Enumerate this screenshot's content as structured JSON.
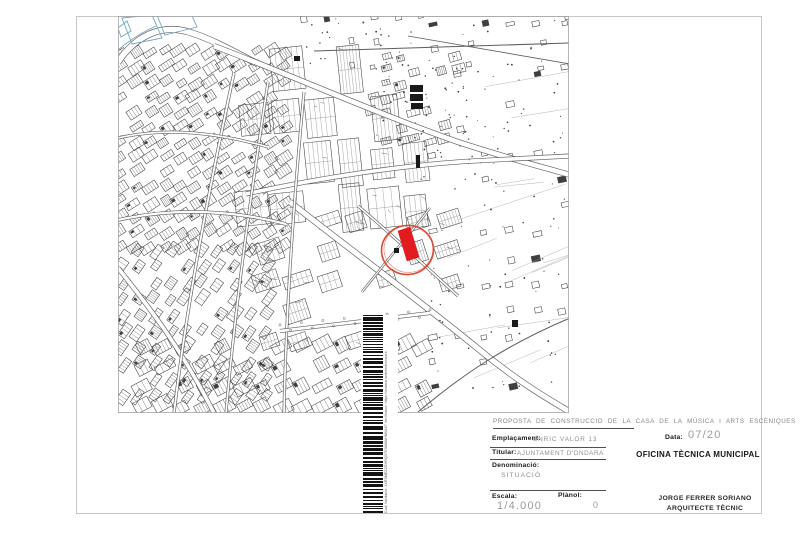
{
  "page": {
    "width": 800,
    "height": 533,
    "bg": "#ffffff"
  },
  "frame": {
    "x": 76,
    "y": 16,
    "w": 686,
    "h": 498,
    "color": "#c6c6c6"
  },
  "map": {
    "viewport": {
      "x": 118,
      "y": 16,
      "w": 451,
      "h": 397,
      "border": "#a5a5a5"
    },
    "ink": "#3f3f3f",
    "ink_faint": "#6f6f6f",
    "road_casing": "#5e5e5e",
    "blue": "#6fa8c4",
    "red_fill": "#e21b1e",
    "red_stroke": "#dc4a33",
    "seed": 42,
    "highlight": {
      "circle": {
        "cx": 289.5,
        "cy": 234,
        "rx": 26,
        "ry": 24.5,
        "rot": -8
      },
      "parcel": [
        [
          280,
          215
        ],
        [
          292,
          211
        ],
        [
          301,
          241
        ],
        [
          289,
          245
        ]
      ]
    },
    "blue_fields": [
      [
        [
          4,
          2
        ],
        [
          34,
          -1
        ],
        [
          44,
          22
        ],
        [
          14,
          28
        ]
      ],
      [
        [
          37,
          -6
        ],
        [
          70,
          -9
        ],
        [
          79,
          11
        ],
        [
          47,
          19
        ]
      ],
      [
        [
          0,
          12
        ],
        [
          9,
          5
        ],
        [
          13,
          15
        ],
        [
          3,
          21
        ]
      ]
    ],
    "blue_line": "M0,34 C12,24 24,16 38,10",
    "roads": [
      {
        "d": "M0,46 C16,22 42,6 74,17 C98,25 118,37 140,48",
        "w": 7,
        "core": true
      },
      {
        "d": "M96,30 C170,58 260,98 340,126 C392,143 428,152 452,159",
        "w": 6,
        "core": true
      },
      {
        "d": "M196,35 L452,27",
        "w": 1,
        "core": false
      },
      {
        "d": "M128,178 C200,162 285,149 355,145 C392,143 428,141 452,140",
        "w": 5,
        "core": true
      },
      {
        "d": "M172,186 C225,228 298,282 358,331 C400,366 432,384 452,396",
        "w": 6.5,
        "core": true
      },
      {
        "d": "M0,252 C32,292 64,334 96,397",
        "w": 5,
        "core": true
      },
      {
        "d": "M116,57 C94,160 70,278 56,397",
        "w": 3.2,
        "core": true
      },
      {
        "d": "M150,66 C134,172 118,282 108,397",
        "w": 3,
        "core": true
      },
      {
        "d": "M186,76 C176,182 168,290 166,397",
        "w": 3,
        "core": true
      },
      {
        "d": "M0,122 C52,110 104,118 150,131",
        "w": 3,
        "core": true
      },
      {
        "d": "M0,204 C62,190 122,196 168,208",
        "w": 3.5,
        "core": true
      },
      {
        "d": "M162,315 L312,297",
        "w": 4,
        "core": true
      },
      {
        "d": "M290,20 L452,48",
        "w": 0.8,
        "core": false
      },
      {
        "d": "M300,396 C345,358 390,328 452,302",
        "w": 1,
        "core": false
      },
      {
        "d": "M240,190 C270,215 305,248 340,280",
        "w": 3,
        "core": true
      },
      {
        "d": "M312,192 C290,220 266,248 244,276",
        "w": 2.5,
        "core": true
      }
    ],
    "regions": [
      {
        "x": 2,
        "y": 36,
        "w": 175,
        "h": 205,
        "step": 15,
        "angle": -33,
        "cw": 12,
        "ch": 8,
        "density": 0.93,
        "style": "dense"
      },
      {
        "x": 5,
        "y": 235,
        "w": 160,
        "h": 160,
        "step": 16,
        "angle": -55,
        "cw": 13,
        "ch": 8,
        "density": 0.88,
        "style": "dense"
      },
      {
        "x": 135,
        "y": 55,
        "w": 180,
        "h": 150,
        "stepx": 33,
        "stepy": 46,
        "angle": -6,
        "cw": 27,
        "ch": 38,
        "density": 0.8,
        "style": "block"
      },
      {
        "x": 150,
        "y": 205,
        "w": 190,
        "h": 130,
        "step": 30,
        "angle": -18,
        "cw": 23,
        "ch": 17,
        "density": 0.55,
        "style": "block"
      },
      {
        "x": 25,
        "y": 330,
        "w": 290,
        "h": 65,
        "step": 20,
        "angle": -28,
        "cw": 16,
        "ch": 11,
        "density": 0.85,
        "style": "dense"
      },
      {
        "x": 255,
        "y": 40,
        "w": 90,
        "h": 90,
        "step": 14,
        "angle": -15,
        "cw": 10,
        "ch": 7,
        "density": 0.5,
        "style": "dense"
      },
      {
        "x": 315,
        "y": 8,
        "w": 135,
        "h": 385,
        "step": 26,
        "angle": -12,
        "cw": 7,
        "ch": 5,
        "density": 0.45,
        "style": "tiny"
      },
      {
        "x": 185,
        "y": 2,
        "w": 265,
        "h": 55,
        "step": 24,
        "angle": -10,
        "cw": 6,
        "ch": 5,
        "density": 0.4,
        "style": "tiny"
      }
    ],
    "landmarks": [
      [
        292,
        69,
        13,
        7
      ],
      [
        292,
        78,
        13,
        7
      ],
      [
        293,
        87,
        12,
        6
      ],
      [
        298,
        139,
        4,
        13
      ],
      [
        276,
        232,
        5,
        5
      ],
      [
        394,
        304,
        6,
        7
      ],
      [
        176,
        40,
        6,
        5
      ]
    ],
    "field_lines": {
      "n": 14,
      "x": 316,
      "y": 24,
      "w": 132,
      "h": 350
    },
    "dot_areas": [
      [
        300,
        4,
        150,
        200,
        70
      ],
      [
        300,
        204,
        150,
        186,
        45
      ],
      [
        186,
        2,
        110,
        50,
        25
      ],
      [
        250,
        45,
        100,
        80,
        30
      ]
    ],
    "tree_row": {
      "x1": 162,
      "y1": 312,
      "x2": 312,
      "y2": 297,
      "n": 15
    }
  },
  "stamp": {
    "x": 361,
    "y": 315,
    "w": 37,
    "h": 198,
    "bar_x": 2,
    "bar_w": 20,
    "seed": 7,
    "caption_lines": [
      "Codi Validació: 4XR5MEZ2GHRQ37G9AMAHMVA97",
      "Verificació: https://ondara.sedelectronica.es/"
    ]
  },
  "titleblock": {
    "project_title": "PROPOSTA DE CONSTRUCCIO DE LA CASA DE LA MÚSICA I ARTS ESCÈNIQUES",
    "emplacament_label": "Emplaçament:",
    "emplacament_value": "ENRIC VALOR 13",
    "data_label": "Data:",
    "data_value": "07/20",
    "titular_label": "Titular:",
    "titular_value": "AJUNTAMENT D'ONDARA",
    "office": "OFICINA TÈCNICA MUNICIPAL",
    "denominacio_label": "Denominació:",
    "denominacio_value": "SITUACIÓ",
    "escala_label": "Escala:",
    "escala_value": "1/4.000",
    "planol_label": "Plànol:",
    "planol_value": "0",
    "author_line1": "JORGE FERRER SORIANO",
    "author_line2": "ARQUITECTE TÈCNIC"
  }
}
